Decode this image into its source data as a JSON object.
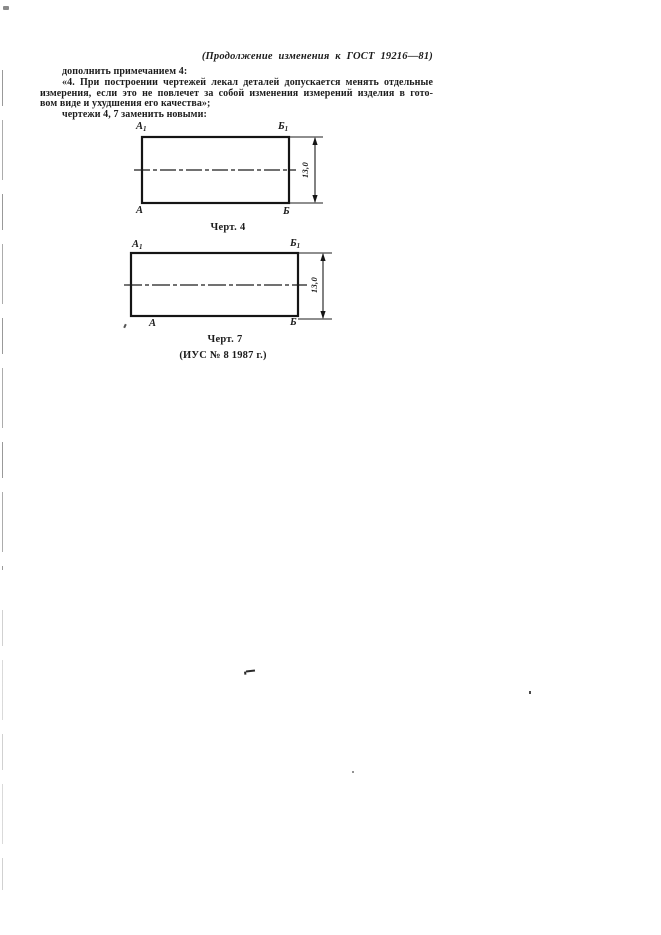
{
  "colors": {
    "ink": "#1c1c1c",
    "paper": "#ffffff"
  },
  "document": {
    "header_note": "(Продолжение изменения к ГОСТ 19216—81)",
    "body": {
      "intro_line": "дополнить примечанием 4:",
      "quote_line_1": "«4. При построении чертежей лекал деталей допускается менять отдельные",
      "quote_line_2": "измерения, если это не повлечет за собой изменения измерений изделия в гото-",
      "quote_line_3": "вом виде и ухудшения его качества»;",
      "closing_line": "чертежи 4, 7 заменить новыми:"
    },
    "figures": [
      {
        "caption": "Черт. 4",
        "dimension_label": "13,0",
        "corner_labels": {
          "top_left": "А",
          "top_left_index": "1",
          "top_right": "Б",
          "top_right_index": "1",
          "bottom_left": "А",
          "bottom_right": "Б"
        }
      },
      {
        "caption": "Черт. 7",
        "dimension_label": "13,0",
        "corner_labels": {
          "top_left": "А",
          "top_left_index": "1",
          "top_right": "Б",
          "top_right_index": "1",
          "bottom_left": "А",
          "bottom_right": "Б"
        }
      }
    ],
    "footer_note": "(ИУС № 8 1987 г.)"
  }
}
